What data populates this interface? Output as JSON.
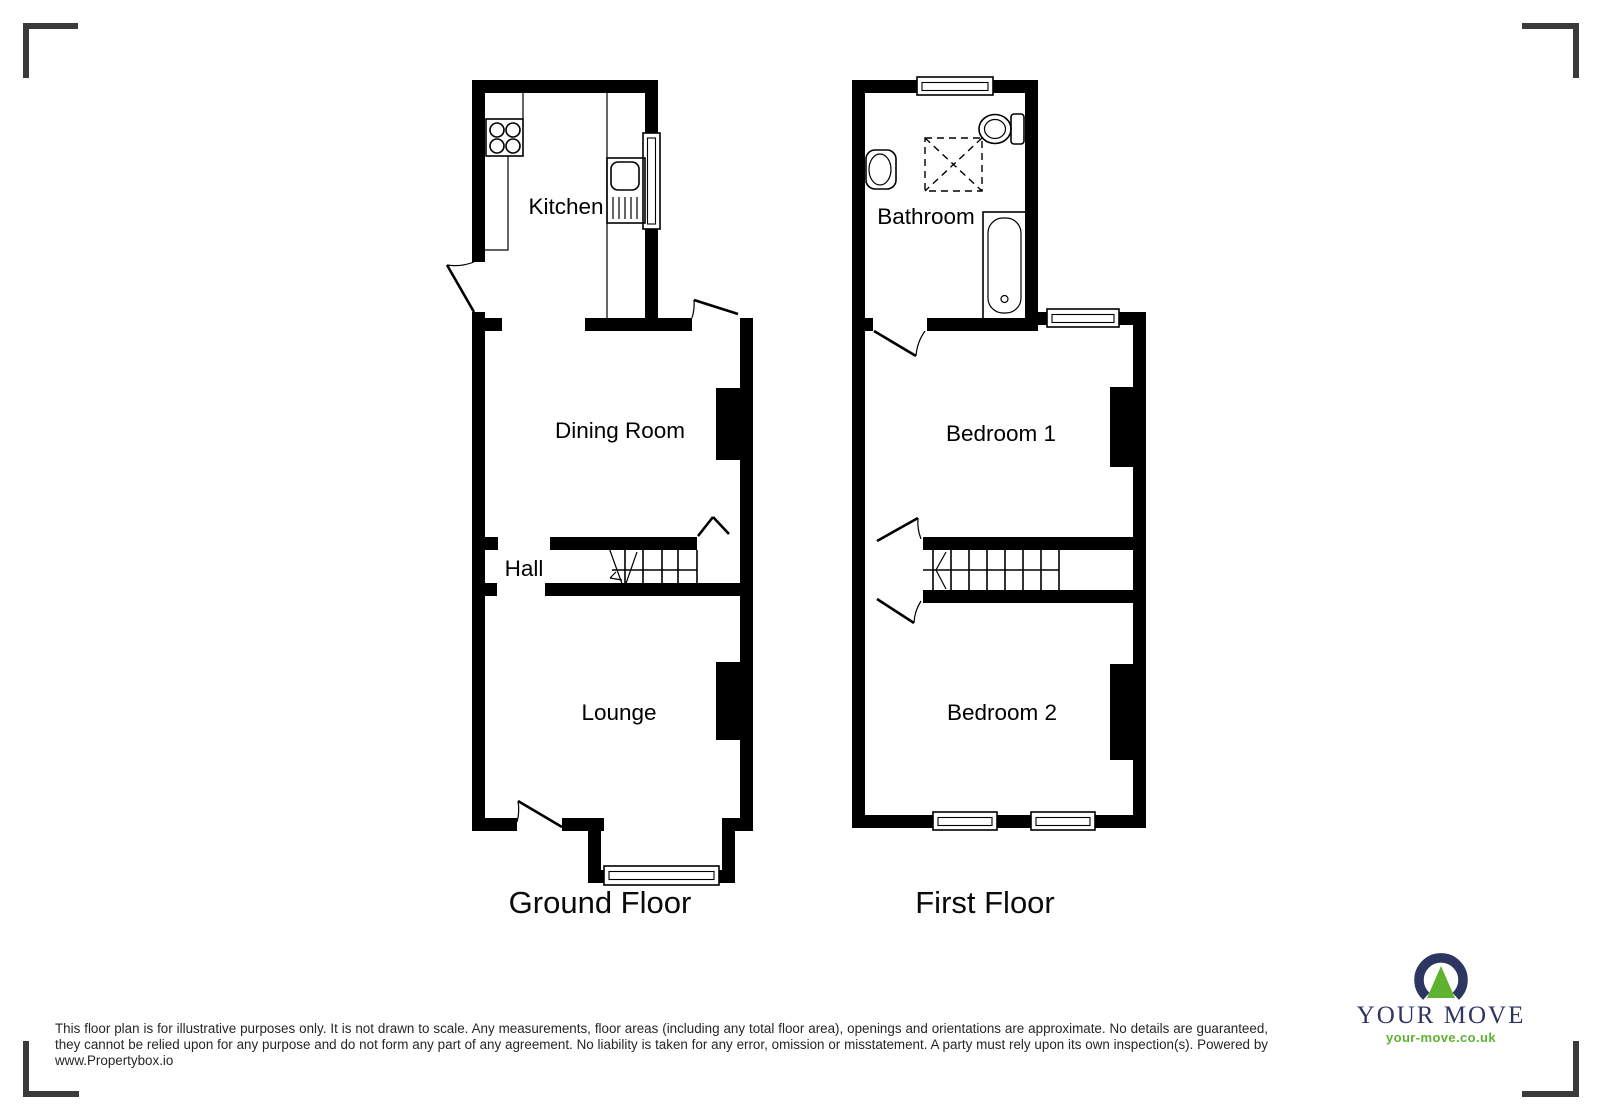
{
  "plan": {
    "ground_floor": {
      "title": "Ground Floor",
      "rooms": {
        "kitchen": "Kitchen",
        "dining_room": "Dining Room",
        "hall": "Hall",
        "lounge": "Lounge"
      }
    },
    "first_floor": {
      "title": "First Floor",
      "rooms": {
        "bathroom": "Bathroom",
        "bedroom1": "Bedroom 1",
        "bedroom2": "Bedroom 2"
      }
    }
  },
  "footer": {
    "disclaimer": "This floor plan is for illustrative purposes only. It is not drawn to scale. Any measurements, floor areas (including any total floor area), openings and orientations are approximate. No details are guaranteed, they cannot be relied upon for any purpose and do not form any part of any agreement. No liability is taken for any error, omission or misstatement. A party must rely upon its own inspection(s). Powered by www.Propertybox.io"
  },
  "logo": {
    "brand": "YOUR MOVE",
    "website": "your-move.co.uk",
    "colors": {
      "navy": "#2d3561",
      "green": "#5fb130"
    }
  }
}
